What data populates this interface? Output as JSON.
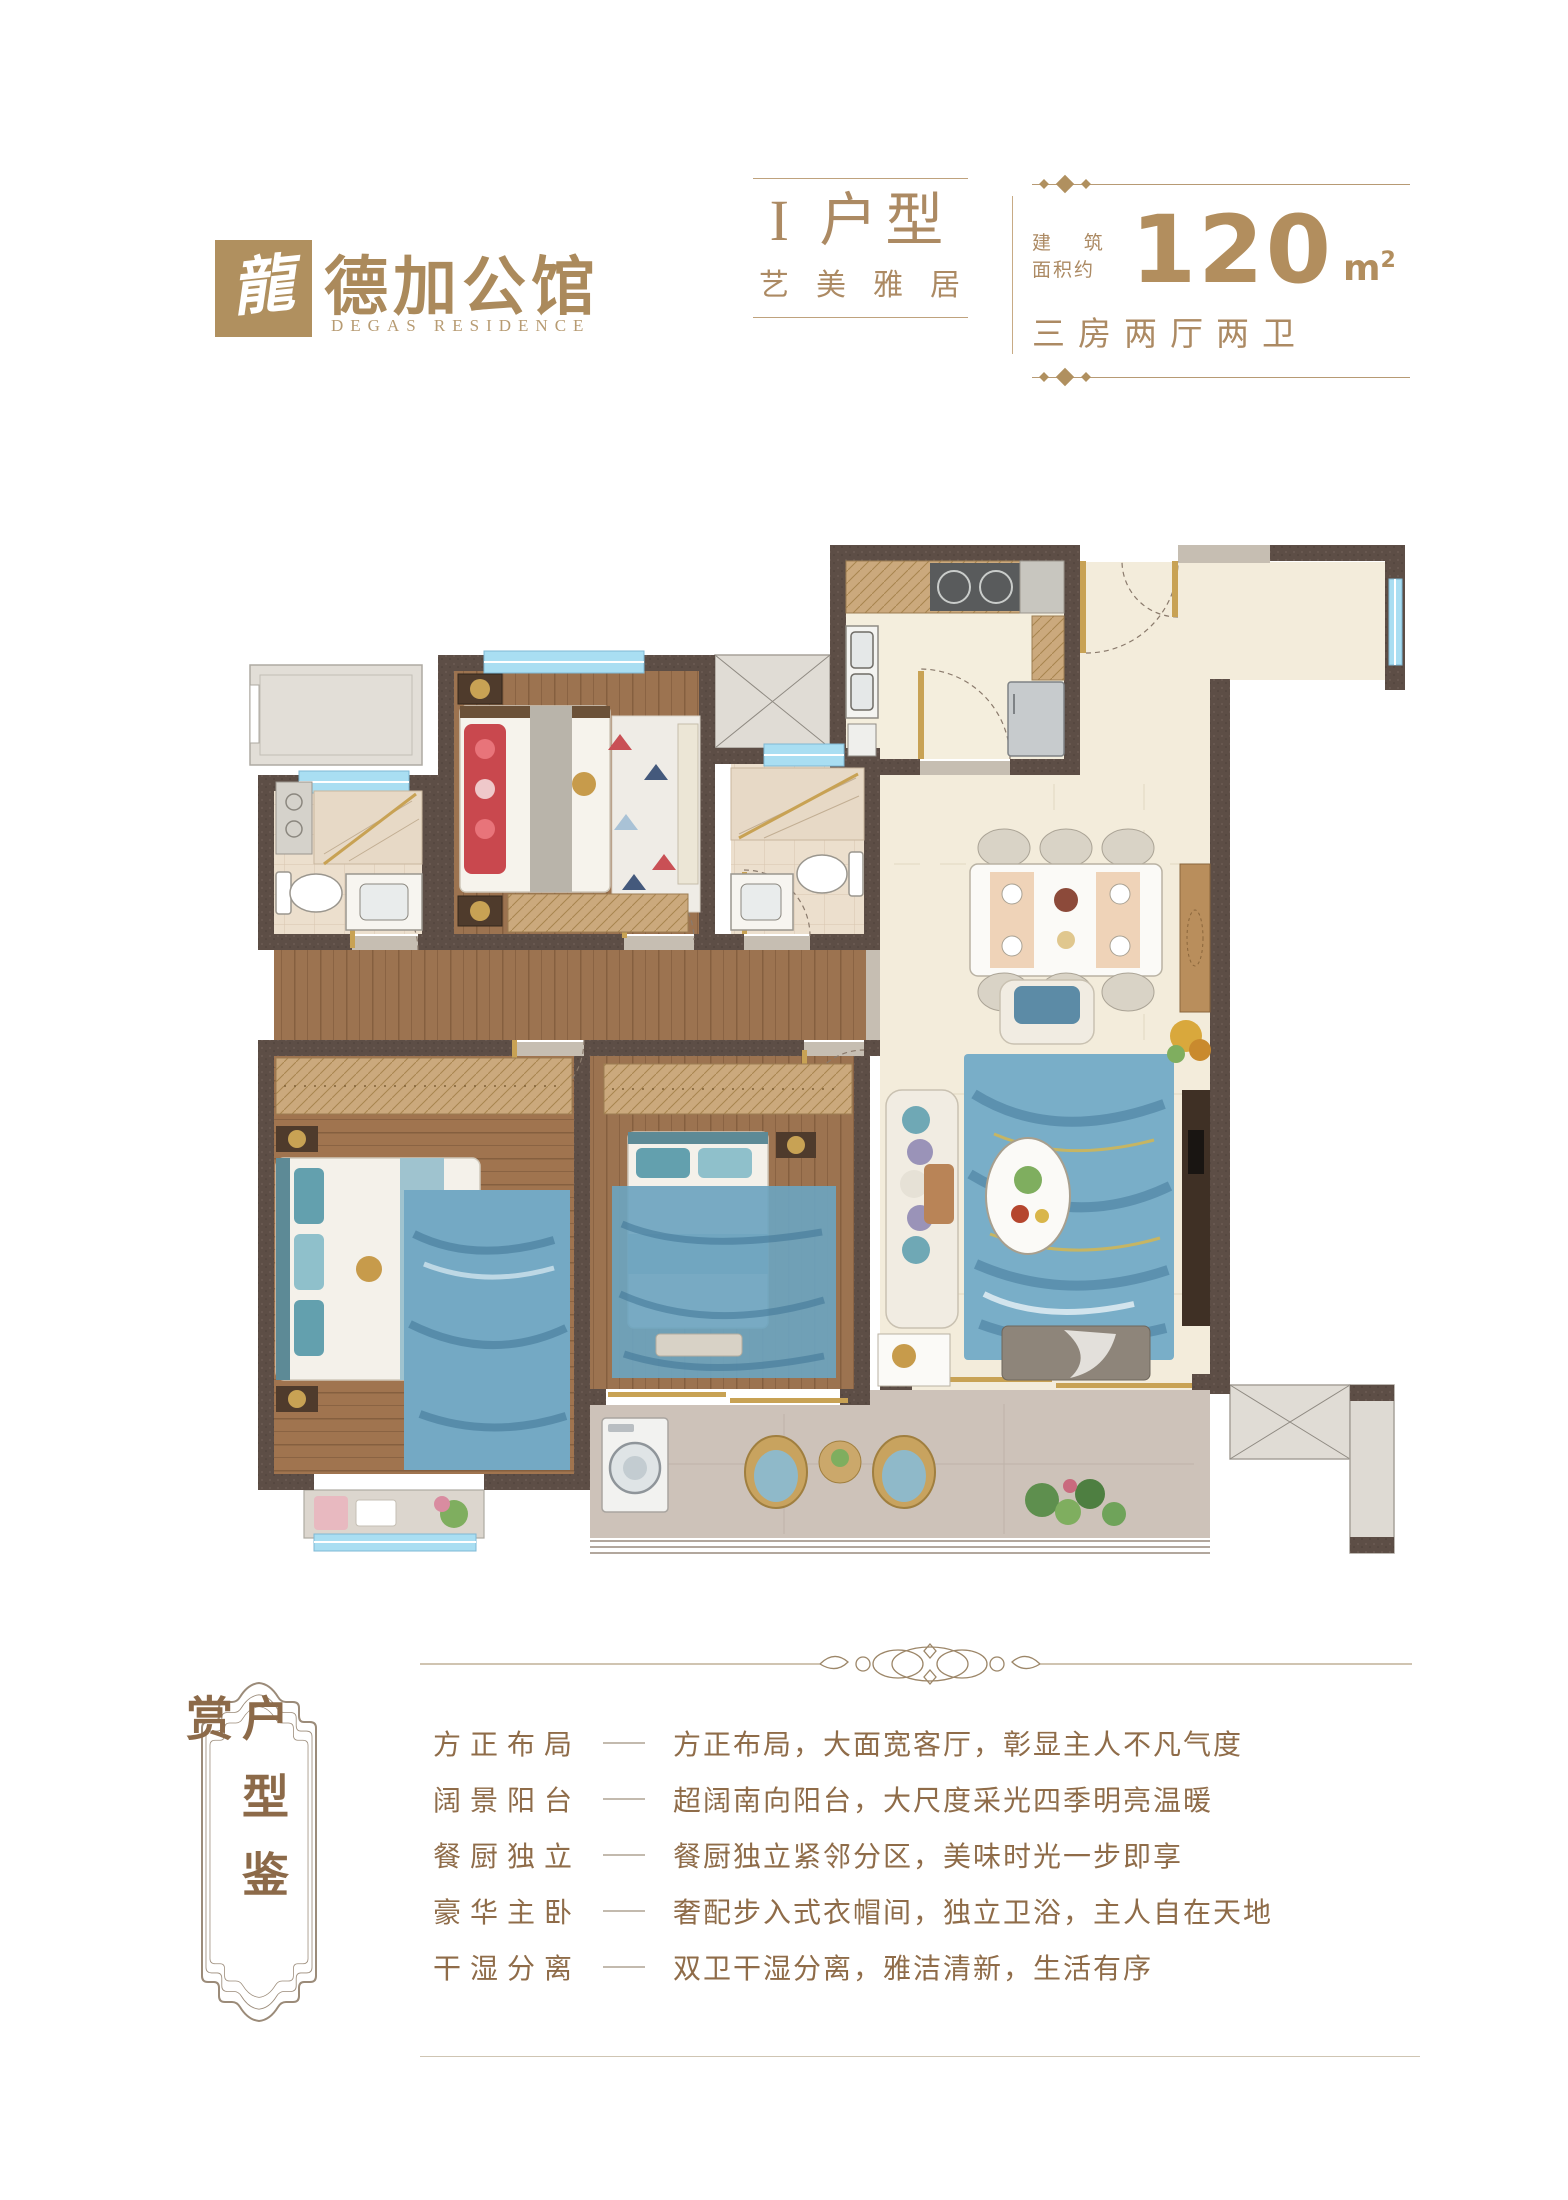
{
  "brand": {
    "logo_mark": "龍",
    "name_cn": "德加公馆",
    "name_en": "DEGAS RESIDENCE"
  },
  "header": {
    "unit_title": "I 户型",
    "unit_subtitle": "艺美雅居",
    "area_label_line1": "建 筑",
    "area_label_line2": "面积约",
    "area_value": "120",
    "area_unit": "m",
    "area_unit_sup": "2",
    "layout_spec": "三房两厅两卫"
  },
  "footer": {
    "section_title": "户型鉴赏",
    "features": [
      {
        "label": "方正布局",
        "desc": "方正布局，大面宽客厅，彰显主人不凡气度"
      },
      {
        "label": "阔景阳台",
        "desc": "超阔南向阳台，大尺度采光四季明亮温暖"
      },
      {
        "label": "餐厨独立",
        "desc": "餐厨独立紧邻分区，美味时光一步即享"
      },
      {
        "label": "豪华主卧",
        "desc": "奢配步入式衣帽间，独立卫浴，主人自在天地"
      },
      {
        "label": "干湿分离",
        "desc": "双卫干湿分离，雅洁清新，生活有序"
      }
    ]
  },
  "colors": {
    "accent_gold": "#b0905f",
    "text_brown": "#8f6c49",
    "wall": "#5d4e46",
    "wood_floor": "#9c7350",
    "marble_floor": "#f3ecdb",
    "tile_floor": "#ecdfcd",
    "balcony_floor": "#cdc2b9",
    "window_blue": "#a9def2",
    "door_gold": "#c8a254"
  }
}
